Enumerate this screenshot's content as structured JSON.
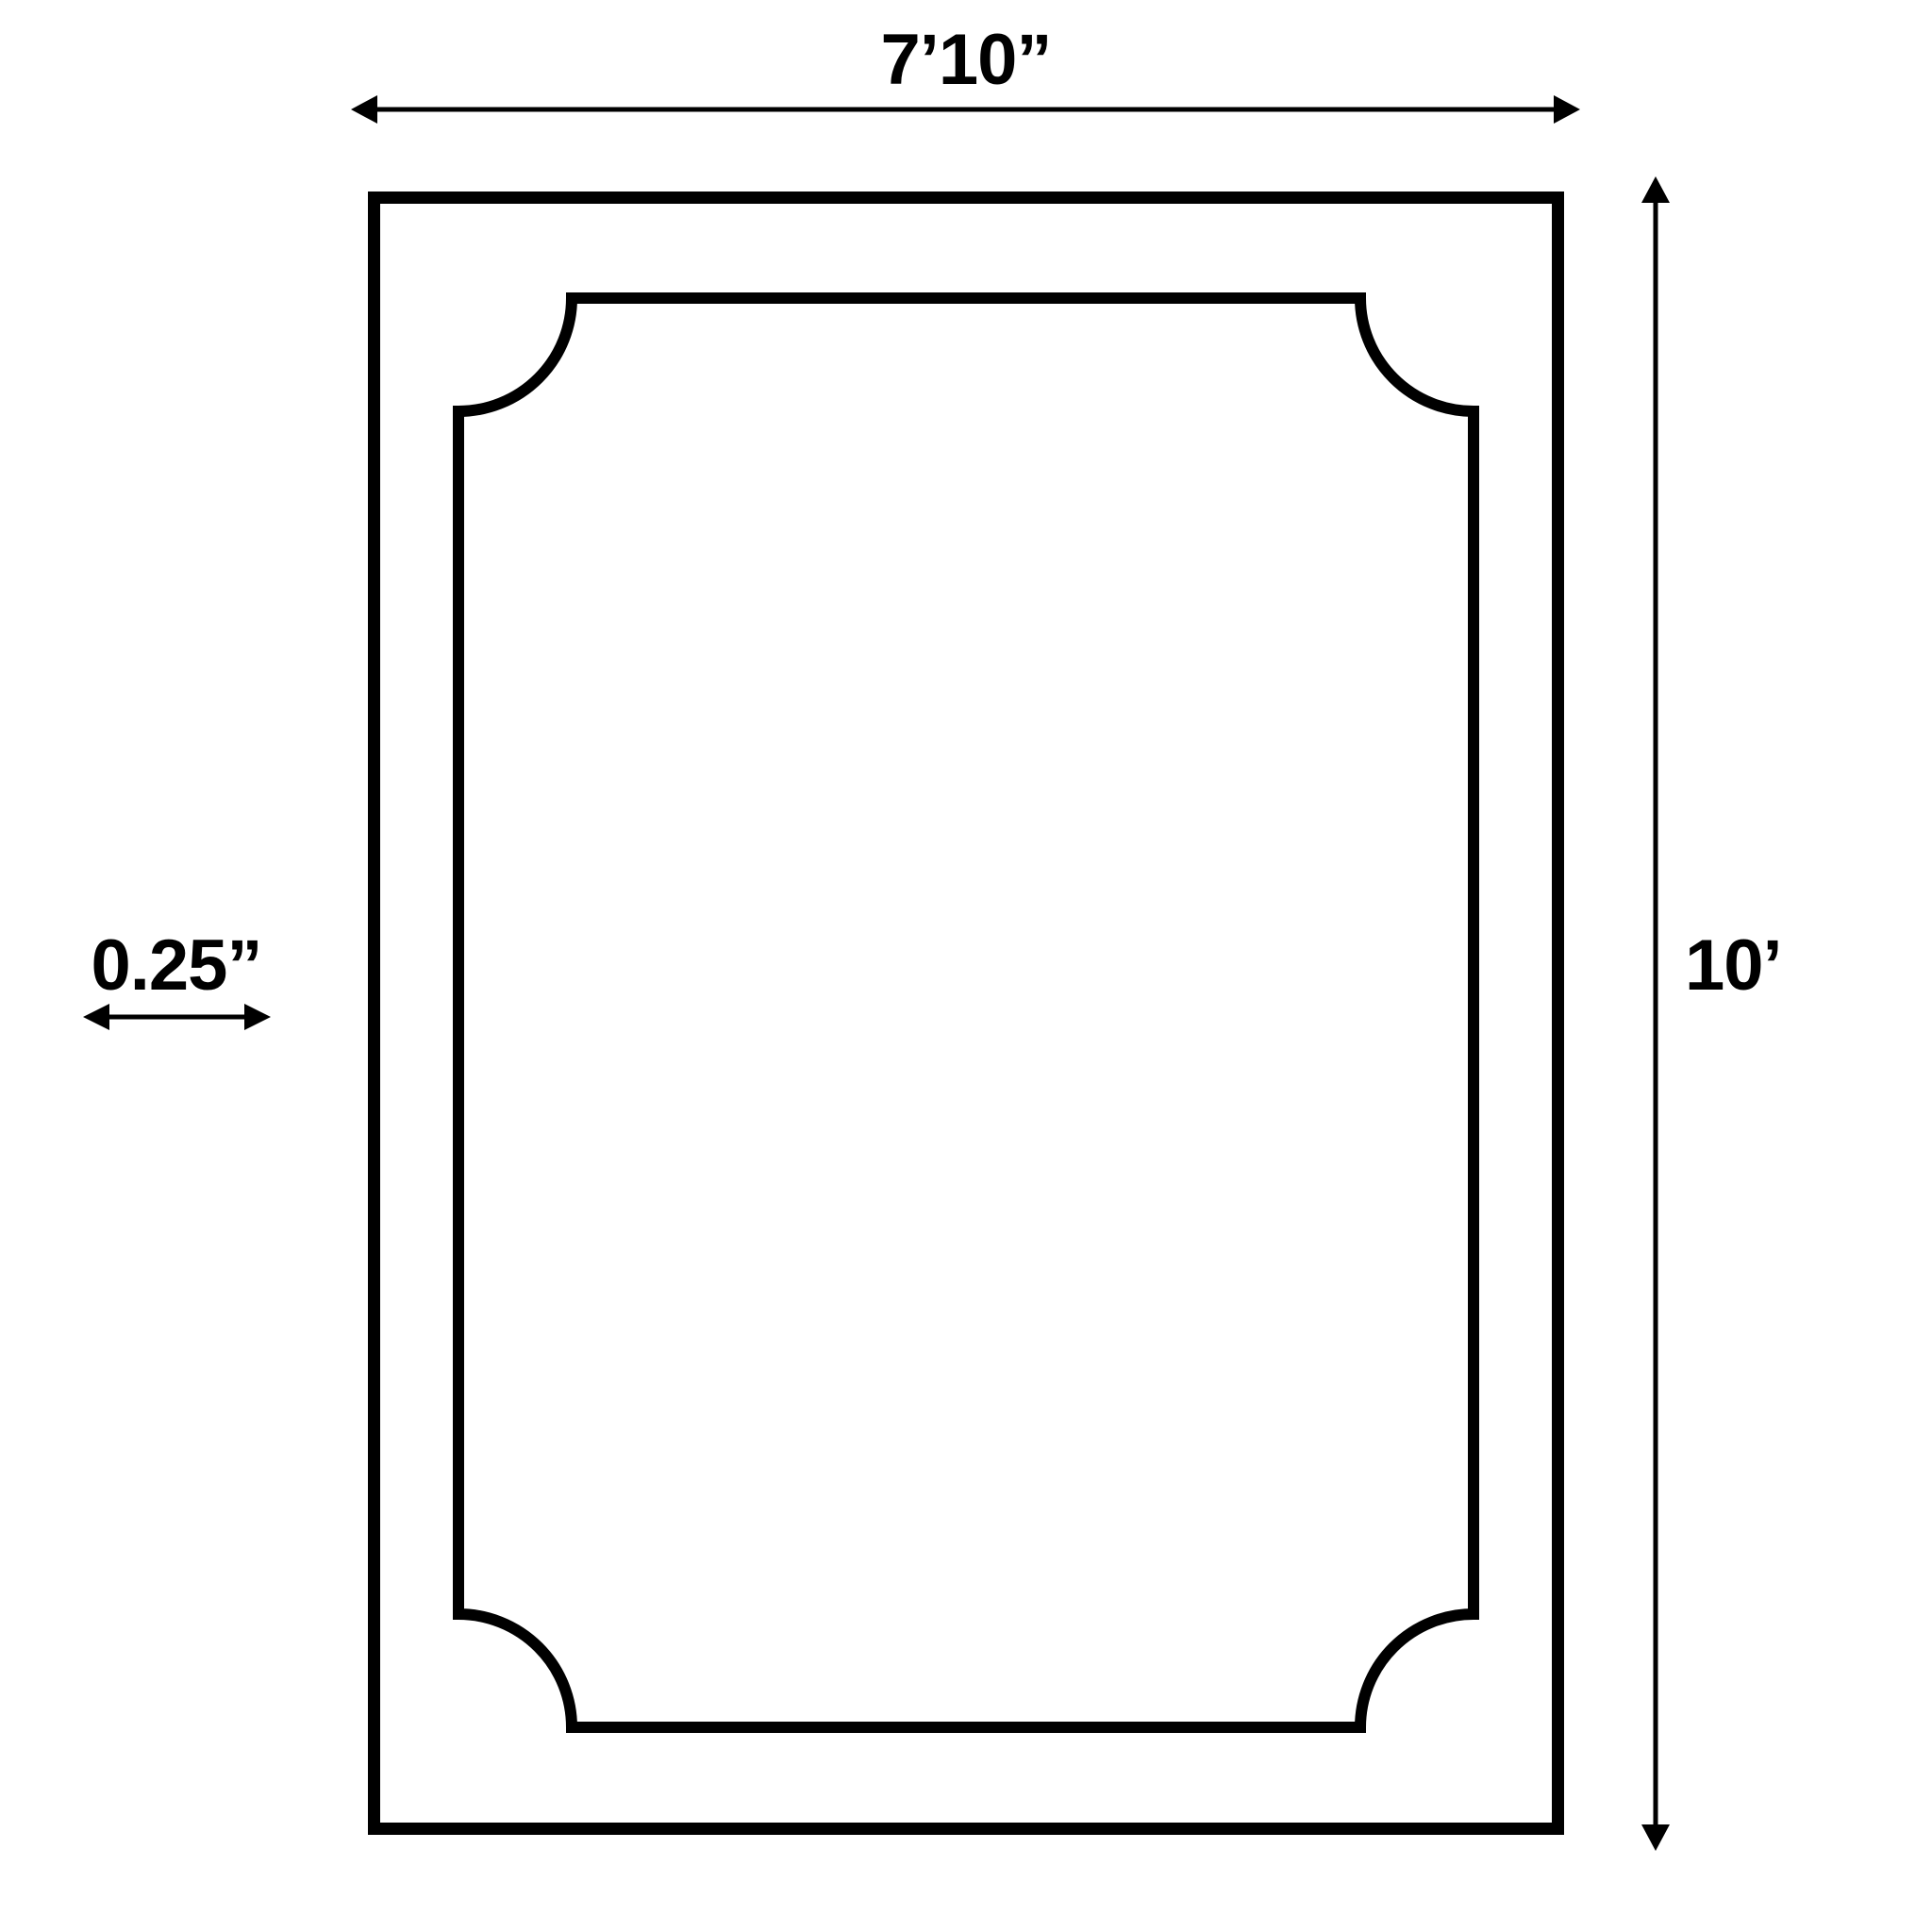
{
  "diagram": {
    "type": "dimension-diagram",
    "shape": "rectangle with inner border line and scooped (concave quarter-circle) corners",
    "width_label": "7’10”",
    "height_label": "10’",
    "thickness_label": "0.25”",
    "dimensions": {
      "width": "7 ft 10 in",
      "height": "10 ft",
      "border_thickness": "0.25 in"
    },
    "colors": {
      "line": "#000000",
      "background": "#ffffff"
    }
  }
}
